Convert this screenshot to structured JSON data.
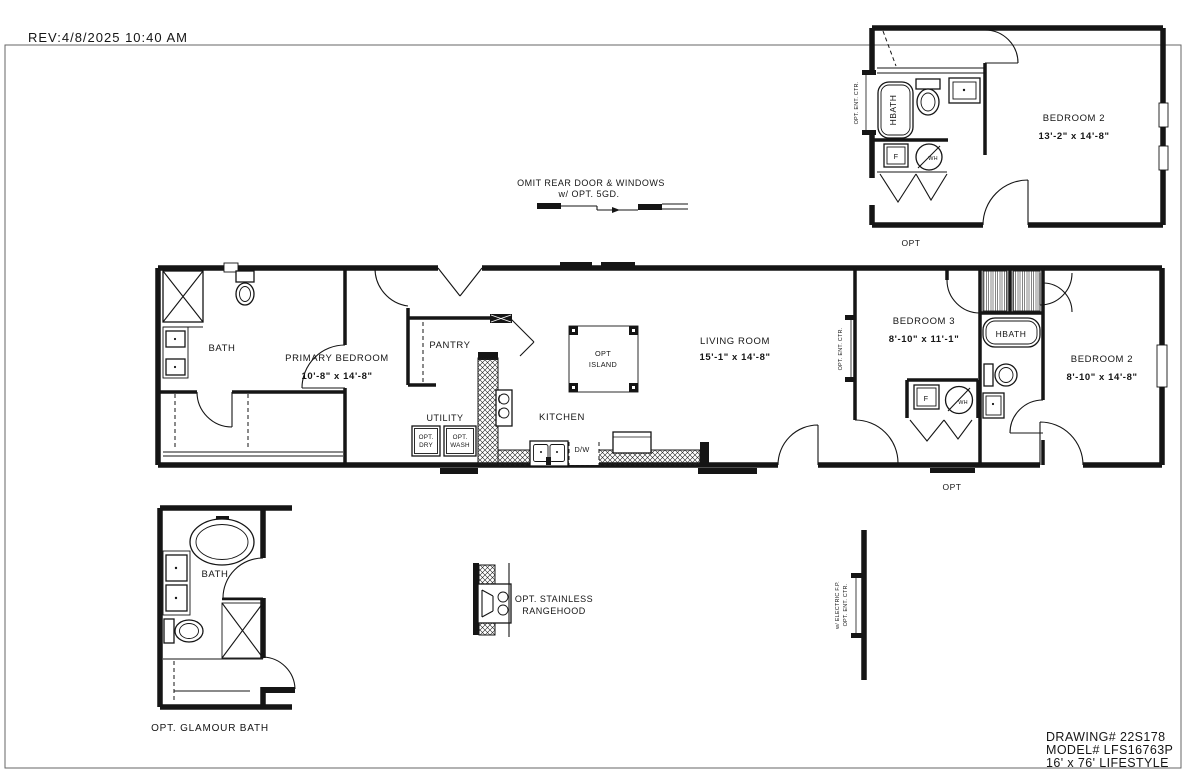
{
  "colors": {
    "line": "#151515",
    "bg": "#ffffff",
    "paper_border": "#666666"
  },
  "rev_note": "REV:4/8/2025 10:40 AM",
  "omit_note": {
    "line1": "OMIT REAR DOOR & WINDOWS",
    "line2": "w/ OPT. 5GD."
  },
  "title_block": {
    "drawing_no": "DRAWING# 22S178",
    "model_no": "MODEL# LFS16763P",
    "series": "16' x 76' LIFESTYLE"
  },
  "opt_unit": {
    "bedroom2_name": "BEDROOM 2",
    "bedroom2_dims": "13'-2\" x  14'-8\"",
    "hbath": "HBATH",
    "furnace": "F",
    "water_heater": "WH",
    "ent_ctr": "OPT. ENT. CTR.",
    "opt": "OPT"
  },
  "main_plan": {
    "bath": "BATH",
    "primary_name": "PRIMARY BEDROOM",
    "primary_dims": "10'-8\" x  14'-8\"",
    "pantry": "PANTRY",
    "utility": "UTILITY",
    "opt_dry_1": "OPT.",
    "opt_dry_2": "DRY",
    "opt_wash_1": "OPT.",
    "opt_wash_2": "WASH",
    "kitchen": "KITCHEN",
    "island_1": "OPT",
    "island_2": "ISLAND",
    "dishwasher": "D/W",
    "living_name": "LIVING ROOM",
    "living_dims": "15'-1\" x  14'-8\"",
    "bed3_name": "BEDROOM 3",
    "bed3_dims": "8'-10\" x  11'-1\"",
    "hbath": "HBATH",
    "bed2_name": "BEDROOM 2",
    "bed2_dims": "8'-10\" x  14'-8\"",
    "furnace": "F",
    "water_heater": "WH",
    "ent_ctr": "OPT. ENT. CTR.",
    "opt": "OPT"
  },
  "glamour_bath": {
    "bath": "BATH",
    "caption": "OPT. GLAMOUR BATH"
  },
  "rangehood_note": {
    "line1": "OPT. STAINLESS",
    "line2": "RANGEHOOD"
  },
  "fp_note": {
    "line1": "OPT. ENT. CTR.",
    "line2": "w/ ELECTRIC F.P."
  }
}
